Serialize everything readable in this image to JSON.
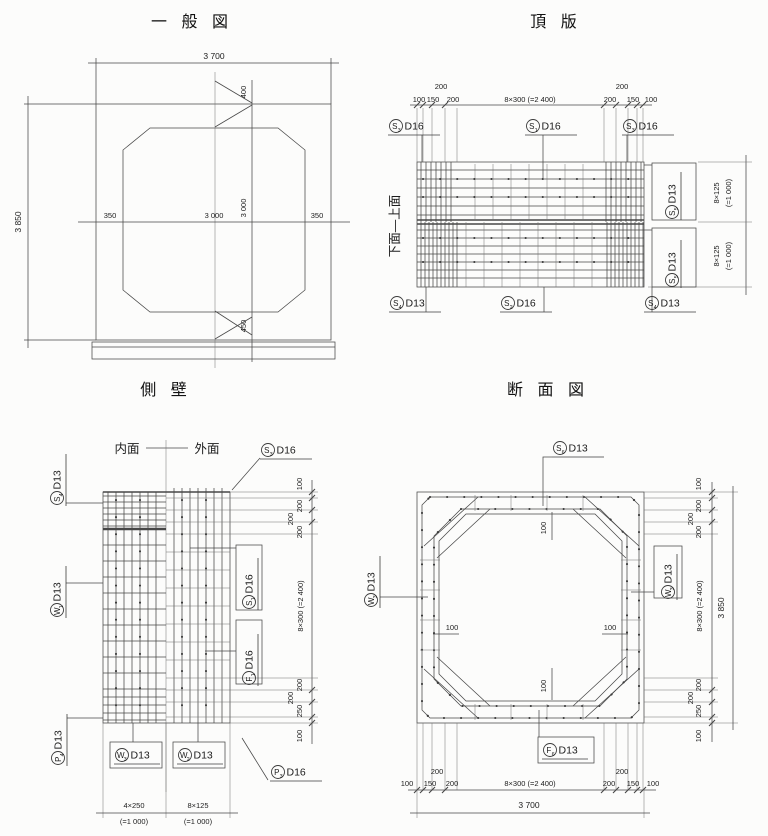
{
  "titles": {
    "general": "一 般 図",
    "top_slab": "頂 版",
    "side_wall": "側 壁",
    "section": "断 面 図"
  },
  "general": {
    "dim_width": "3 700",
    "dim_height": "3 850",
    "wall_left": "350",
    "inner_w": "3 000",
    "inner_h": "3 000",
    "wall_right": "350",
    "haunch_top": "400",
    "haunch_bottom": "450"
  },
  "top_slab": {
    "face_label": "下面—上面",
    "top_dims": {
      "d100l": "100",
      "d150l": "150",
      "d200l_hi": "200",
      "d200l": "200",
      "span": "8×300 (=2 400)",
      "d200r": "200",
      "d200r_hi": "200",
      "d150r": "150",
      "d100r": "100"
    },
    "right_dims": {
      "upper_a": "8×125",
      "upper_b": "(=1 000)",
      "lower_a": "8×125",
      "lower_b": "(=1 000)"
    },
    "labels": {
      "s3_left": {
        "letter": "S",
        "sub": "3",
        "size": "D16"
      },
      "s1_top": {
        "letter": "S",
        "sub": "1",
        "size": "D16"
      },
      "s3_right": {
        "letter": "S",
        "sub": "3",
        "size": "D16"
      },
      "s4_left": {
        "letter": "S",
        "sub": "4",
        "size": "D13"
      },
      "s2_bottom": {
        "letter": "S",
        "sub": "2",
        "size": "D16"
      },
      "s4_right": {
        "letter": "S",
        "sub": "4",
        "size": "D13"
      },
      "s5_upper": {
        "letter": "S",
        "sub": "5",
        "size": "D13"
      },
      "s5_lower": {
        "letter": "S",
        "sub": "5",
        "size": "D13"
      }
    }
  },
  "side_wall": {
    "inner_face": "内面",
    "outer_face": "外面",
    "bottom_dims": {
      "left_a": "4×250",
      "left_b": "(=1 000)",
      "right_a": "8×125",
      "right_b": "(=1 000)"
    },
    "right_dims": {
      "d100t": "100",
      "d200a": "200",
      "d200b": "200",
      "d200c": "200",
      "span": "8×300 (=2 400)",
      "d200d": "200",
      "d200e": "200",
      "d250": "250",
      "d100b": "100"
    },
    "labels": {
      "s4": {
        "letter": "S",
        "sub": "4",
        "size": "D13"
      },
      "w1": {
        "letter": "W",
        "sub": "1",
        "size": "D13"
      },
      "p4": {
        "letter": "P",
        "sub": "4",
        "size": "D13"
      },
      "s3": {
        "letter": "S",
        "sub": "3",
        "size": "D16"
      },
      "s1": {
        "letter": "S",
        "sub": "1",
        "size": "D16"
      },
      "f1": {
        "letter": "F",
        "sub": "1",
        "size": "D16"
      },
      "p3": {
        "letter": "P",
        "sub": "3",
        "size": "D16"
      },
      "w3": {
        "letter": "W",
        "sub": "3",
        "size": "D13"
      },
      "w2": {
        "letter": "W",
        "sub": "2",
        "size": "D13"
      }
    }
  },
  "section": {
    "inner_dims": {
      "top": "100",
      "left": "100",
      "right": "100",
      "bottom": "100"
    },
    "bottom_dims": {
      "d100l": "100",
      "d150l": "150",
      "d200l_hi": "200",
      "d200l": "200",
      "span": "8×300 (=2 400)",
      "d200r": "200",
      "d200r_hi": "200",
      "d150r": "150",
      "d100r": "100",
      "total": "3 700"
    },
    "right_dims": {
      "d100t": "100",
      "d200a": "200",
      "d200b": "200",
      "d200c": "200",
      "span": "8×300 (=2 400)",
      "d200d": "200",
      "d200e": "200",
      "d250": "250",
      "d100b": "100",
      "total": "3 850"
    },
    "labels": {
      "s6": {
        "letter": "S",
        "sub": "6",
        "size": "D13"
      },
      "f6": {
        "letter": "F",
        "sub": "6",
        "size": "D13"
      },
      "w3_left": {
        "letter": "W",
        "sub": "3",
        "size": "D13"
      },
      "w3_right": {
        "letter": "W",
        "sub": "3",
        "size": "D13"
      }
    }
  }
}
